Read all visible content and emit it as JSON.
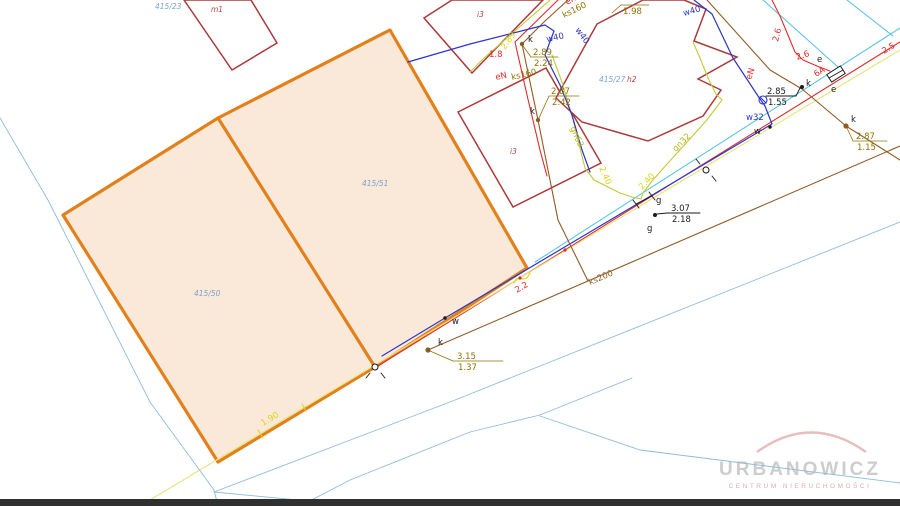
{
  "watermark": {
    "name": "URBANOWICZ",
    "subtitle": "CENTRUM NIERUCHOMOŚCI"
  },
  "map": {
    "parcel_highlight": {
      "points": "390,30 218,118 63,215 218,462 375,367 527,268"
    },
    "parcel_divider": {
      "points": "218,118 375,367"
    },
    "buildings": [
      {
        "name": "building-m1",
        "points": "184,0 232,70 277,43 251,0"
      },
      {
        "name": "building-i3-top",
        "points": "424,18 452,0 543,0 472,73"
      },
      {
        "name": "building-i3-mid",
        "points": "458,112 546,68 601,163 513,207"
      },
      {
        "name": "building-h2",
        "points": "643,0 597,24 556,98 582,122 648,141 703,116 721,90 698,79 737,57 694,41 706,9 684,0"
      }
    ],
    "ebox": {
      "points": "845.2,73.4 840.3,65.9 826.8,74.6 831.7,82.1",
      "inner": "843,70 829,78"
    },
    "lines": [
      {
        "name": "road-telecom-line",
        "cls": "ln-cyan",
        "points": "900,28 535,262"
      },
      {
        "name": "telecom-feeder-line",
        "cls": "ln-cyan",
        "points": "763,0 838,67"
      },
      {
        "name": "telecom-stub-line",
        "cls": "ln-cyan",
        "points": "847,0 893,36"
      },
      {
        "name": "power-road-line-eN",
        "cls": "ln-red",
        "points": "900,42 378,366"
      },
      {
        "name": "water-line-w40-w32",
        "cls": "ln-blue",
        "points": "694,0 712,14 733,58 758,96 765,106 772,124 445,318 382,356"
      },
      {
        "name": "gas-main-road-line",
        "cls": "ln-yellow",
        "points": "900,50 150,500"
      },
      {
        "name": "sewer-ks200-line",
        "cls": "ln-brown",
        "points": "900,146 588,281 428,350"
      },
      {
        "name": "sewer-ks160-line",
        "cls": "ln-brown",
        "points": "568,0 545,21 522,44 538,120 558,220 588,281"
      },
      {
        "name": "sewer-ne-service-line",
        "cls": "ln-brown",
        "points": "707,0 770,70 802,89 846,126 900,160"
      },
      {
        "name": "power-west-line-eN",
        "cls": "ln-red",
        "points": "558,0 515,42 527,95 540,150 547,176"
      },
      {
        "name": "power-ne-curve-eN",
        "cls": "ln-red",
        "points": "772,0 780,16 790,40 795,52 803,60 817,66 830,71"
      },
      {
        "name": "gas-west-service-line",
        "cls": "ln-gas",
        "points": "550,0 507,38 484,58 470,72"
      },
      {
        "name": "gas-gn63-line",
        "cls": "ln-gas",
        "points": "552,55 563,85 573,120 580,148 585,168 594,180 606,186 620,193 632,197 641,199"
      },
      {
        "name": "gas-gn32-line",
        "cls": "ln-gas",
        "points": "693,42 700,58 708,78 716,94 722,100 706,121 688,141 668,163 652,181 643,193 641,199"
      },
      {
        "name": "water-w40-west-line",
        "cls": "ln-blue",
        "points": "408,62 470,44 545,25 554,31 545,55 560,85 572,115 582,150 590,172"
      },
      {
        "name": "parcel-boundary-left",
        "cls": "ln-lblue",
        "points": "0,118 48,200 150,402 214,490 218,506"
      },
      {
        "name": "parcel-boundary-long",
        "cls": "ln-lblue",
        "points": "214,492 450,402 900,222"
      },
      {
        "name": "parcel-boundary-stub",
        "cls": "ln-lblue",
        "points": "214,492 360,506"
      },
      {
        "name": "parcel-boundary-se",
        "cls": "ln-lblue",
        "points": "540,416 640,450 900,483"
      },
      {
        "name": "parcel-boundary-curve",
        "cls": "ln-lblue",
        "points": "632,378 540,415 470,432 350,480 300,506"
      },
      {
        "name": "leader-k1",
        "cls": "ln-olive",
        "points": "523,46 531,57 558,57"
      },
      {
        "name": "leader-k2",
        "cls": "ln-olive",
        "points": "539,118 549,96 579,96"
      },
      {
        "name": "leader-k3",
        "cls": "ln-olive",
        "points": "430,351 453,361 503,361"
      },
      {
        "name": "leader-k4",
        "cls": "ln-olive",
        "points": "847,128 853,141 887,141"
      },
      {
        "name": "leader-k-black",
        "cls": "ln-blk",
        "points": "800,88 796,96 766,96"
      },
      {
        "name": "leader-g",
        "cls": "ln-blk",
        "points": "657,214 667,213 700,213"
      },
      {
        "name": "leader-198",
        "cls": "ln-olive",
        "points": "612,13 621,5 649,5"
      },
      {
        "name": "bench1-tick-a",
        "cls": "ln-blk",
        "points": "370,373 366,378"
      },
      {
        "name": "bench1-tick-b",
        "cls": "ln-blk",
        "points": "381,373 385,378"
      },
      {
        "name": "bench2-tick-a",
        "cls": "ln-blk",
        "points": "700,164 696,159"
      },
      {
        "name": "bench2-tick-b",
        "cls": "ln-blk",
        "points": "712,176 716,181"
      },
      {
        "name": "gas-valve-bracket-a",
        "cls": "ln-blk",
        "points": "633,200 639,208"
      },
      {
        "name": "gas-valve-bracket-b",
        "cls": "ln-blk",
        "points": "636,204 652,196"
      },
      {
        "name": "gas-valve-bracket-c",
        "cls": "ln-blk",
        "points": "649,192 655,200"
      },
      {
        "name": "water-valve-cross",
        "cls": "sym-blue ln",
        "points": "760,97 766,103"
      },
      {
        "name": "dist-tick-a",
        "cls": "ln-byellow",
        "points": "258,430 263,438"
      },
      {
        "name": "dist-tick-b",
        "cls": "ln-byellow",
        "points": "302,404 306,411"
      }
    ],
    "paths": [
      {
        "name": "gas-crossing-squiggle",
        "cls": "ln-byellow",
        "d": "M514,283 C518,272 524,286 530,273"
      },
      {
        "name": "watermark-arc",
        "cls": "",
        "d": "M757,452 Q811,413 866,452",
        "stroke": "#e7bdbd",
        "width": 2.5
      }
    ],
    "circles": [
      {
        "name": "water-valve-symbol",
        "cls": "sym-blue",
        "x": 763,
        "y": 100,
        "r": 4
      },
      {
        "name": "benchmark-point-1",
        "cls": "sym-stroke",
        "x": 375,
        "y": 367,
        "r": 3
      },
      {
        "name": "benchmark-point-2",
        "cls": "sym-stroke",
        "x": 706,
        "y": 170,
        "r": 3
      }
    ],
    "points": [
      {
        "name": "manhole-k1",
        "cls": "pt-brown",
        "x": 522,
        "y": 44,
        "r": 2.2
      },
      {
        "name": "manhole-k2",
        "cls": "pt-brown",
        "x": 538,
        "y": 120,
        "r": 2.2
      },
      {
        "name": "manhole-k3",
        "cls": "pt-brown",
        "x": 428,
        "y": 350,
        "r": 2.6
      },
      {
        "name": "manhole-k4",
        "cls": "pt-brown",
        "x": 846,
        "y": 126,
        "r": 2.6
      },
      {
        "name": "manhole-k-black",
        "cls": "pt-blk",
        "x": 802,
        "y": 87,
        "r": 2
      },
      {
        "name": "gas-point-g",
        "cls": "pt-blk",
        "x": 655,
        "y": 215,
        "r": 2
      },
      {
        "name": "water-point-1",
        "cls": "pt-blk",
        "x": 770,
        "y": 127,
        "r": 1.7
      },
      {
        "name": "water-point-2",
        "cls": "pt-blk",
        "x": 445,
        "y": 318,
        "r": 1.7
      },
      {
        "name": "cable-marker-1",
        "cls": "pt-red",
        "x": 565,
        "y": 250,
        "r": 1.6
      },
      {
        "name": "cable-marker-2",
        "cls": "pt-red",
        "x": 520,
        "y": 278,
        "r": 1.6
      }
    ],
    "labels": [
      {
        "name": "parcel-number-415-23",
        "text": "415/23",
        "x": 155,
        "y": 9,
        "rot": 0,
        "cls": "t-parcel"
      },
      {
        "name": "building-label-m1",
        "text": "m1",
        "x": 211,
        "y": 12,
        "rot": 0,
        "cls": "t-bldg"
      },
      {
        "name": "building-label-i3-top",
        "text": "i3",
        "x": 477,
        "y": 17,
        "rot": 0,
        "cls": "t-bldg"
      },
      {
        "name": "building-label-i3-mid",
        "text": "i3",
        "x": 510,
        "y": 154,
        "rot": 0,
        "cls": "t-bldg"
      },
      {
        "name": "building-label-h2",
        "text": "h2",
        "x": 627,
        "y": 82,
        "rot": 0,
        "cls": "t-bldg"
      },
      {
        "name": "parcel-number-415-27",
        "text": "415/27",
        "x": 599,
        "y": 82,
        "rot": 0,
        "cls": "t-parcel"
      },
      {
        "name": "parcel-number-415-51",
        "text": "415/51",
        "x": 362,
        "y": 186,
        "rot": 0,
        "cls": "t-parcel"
      },
      {
        "name": "parcel-number-415-50",
        "text": "415/50",
        "x": 194,
        "y": 296,
        "rot": 0,
        "cls": "t-parcel"
      },
      {
        "name": "power-label-eN-top",
        "text": "eN",
        "x": 567,
        "y": 5,
        "rot": -28,
        "cls": "t-red"
      },
      {
        "name": "sewer-label-ks160-top",
        "text": "ks160",
        "x": 564,
        "y": 18,
        "rot": -26,
        "cls": "t-olive"
      },
      {
        "name": "power-label-eN-mid",
        "text": "eN",
        "x": 496,
        "y": 80,
        "rot": -13,
        "cls": "t-red"
      },
      {
        "name": "sewer-label-ks160-mid",
        "text": "ks160",
        "x": 512,
        "y": 80,
        "rot": -13,
        "cls": "t-olive"
      },
      {
        "name": "dist-label-1-8",
        "text": "1.8",
        "x": 489,
        "y": 57,
        "rot": 0,
        "cls": "t-red"
      },
      {
        "name": "elev-k1-top",
        "text": "2.89",
        "x": 533,
        "y": 55,
        "rot": 0,
        "cls": "t-olive"
      },
      {
        "name": "elev-k1-bot",
        "text": "2.24",
        "x": 534,
        "y": 66,
        "rot": 0,
        "cls": "t-olive"
      },
      {
        "name": "point-label-k1",
        "text": "k",
        "x": 528,
        "y": 42,
        "rot": 0,
        "cls": "t-blk"
      },
      {
        "name": "point-label-k2",
        "text": "k",
        "x": 530,
        "y": 114,
        "rot": 0,
        "cls": "t-blk"
      },
      {
        "name": "elev-k2-top",
        "text": "2.87",
        "x": 551,
        "y": 94,
        "rot": 0,
        "cls": "t-olive"
      },
      {
        "name": "elev-k2-bot",
        "text": "2.42",
        "x": 552,
        "y": 105,
        "rot": 0,
        "cls": "t-olive"
      },
      {
        "name": "depth-label-289-gas",
        "text": "2.89",
        "x": 505,
        "y": 50,
        "rot": -55,
        "cls": "t-yellow"
      },
      {
        "name": "water-label-w40-a",
        "text": "w40",
        "x": 547,
        "y": 42,
        "rot": -12,
        "cls": "t-blue"
      },
      {
        "name": "water-label-w40-b",
        "text": "w40",
        "x": 575,
        "y": 30,
        "rot": 54,
        "cls": "t-blue"
      },
      {
        "name": "water-label-w40-c",
        "text": "w40",
        "x": 684,
        "y": 16,
        "rot": -16,
        "cls": "t-blue"
      },
      {
        "name": "elev-label-198",
        "text": "1.98",
        "x": 623,
        "y": 14,
        "rot": 0,
        "cls": "t-olive"
      },
      {
        "name": "gas-label-gn63",
        "text": "gn63",
        "x": 570,
        "y": 128,
        "rot": 66,
        "cls": "t-gas"
      },
      {
        "name": "depth-label-240-a",
        "text": "2.40",
        "x": 599,
        "y": 168,
        "rot": 66,
        "cls": "t-yellow"
      },
      {
        "name": "gas-label-gn32",
        "text": "gn32",
        "x": 676,
        "y": 152,
        "rot": -46,
        "cls": "t-gas"
      },
      {
        "name": "depth-label-240-b",
        "text": "2.40",
        "x": 642,
        "y": 190,
        "rot": -46,
        "cls": "t-yellow"
      },
      {
        "name": "sewer-label-ks200",
        "text": "ks200",
        "x": 590,
        "y": 285,
        "rot": -23,
        "cls": "t-brown"
      },
      {
        "name": "dist-label-2-2",
        "text": "2.2",
        "x": 517,
        "y": 293,
        "rot": -31,
        "cls": "t-red"
      },
      {
        "name": "dist-label-1-90",
        "text": "1.90",
        "x": 263,
        "y": 426,
        "rot": -31,
        "cls": "t-yellow"
      },
      {
        "name": "elev-k3-top",
        "text": "3.15",
        "x": 457,
        "y": 359,
        "rot": 0,
        "cls": "t-olive"
      },
      {
        "name": "elev-k3-bot",
        "text": "1.37",
        "x": 458,
        "y": 370,
        "rot": 0,
        "cls": "t-olive"
      },
      {
        "name": "point-label-k3",
        "text": "k",
        "x": 438,
        "y": 345,
        "rot": 0,
        "cls": "t-blk"
      },
      {
        "name": "point-label-w2",
        "text": "w",
        "x": 452,
        "y": 324,
        "rot": 0,
        "cls": "t-blk"
      },
      {
        "name": "elev-g-top",
        "text": "3.07",
        "x": 671,
        "y": 211,
        "rot": 0,
        "cls": "t-blk"
      },
      {
        "name": "elev-g-bot",
        "text": "2.18",
        "x": 672,
        "y": 222,
        "rot": 0,
        "cls": "t-blk"
      },
      {
        "name": "point-label-g-dot",
        "text": "g",
        "x": 647,
        "y": 231,
        "rot": 0,
        "cls": "t-blk"
      },
      {
        "name": "point-label-g-valve",
        "text": "g",
        "x": 656,
        "y": 203,
        "rot": 0,
        "cls": "t-blk"
      },
      {
        "name": "elev-k4-top",
        "text": "2.87",
        "x": 856,
        "y": 139,
        "rot": 0,
        "cls": "t-olive"
      },
      {
        "name": "elev-k4-bot",
        "text": "1.15",
        "x": 857,
        "y": 150,
        "rot": 0,
        "cls": "t-olive"
      },
      {
        "name": "point-label-k4",
        "text": "k",
        "x": 851,
        "y": 122,
        "rot": 0,
        "cls": "t-blk"
      },
      {
        "name": "elev-kblack-top",
        "text": "2.85",
        "x": 767,
        "y": 94,
        "rot": 0,
        "cls": "t-blk"
      },
      {
        "name": "elev-kblack-bot",
        "text": "1.55",
        "x": 768,
        "y": 105,
        "rot": 0,
        "cls": "t-blk"
      },
      {
        "name": "point-label-k-black",
        "text": "k",
        "x": 806,
        "y": 86,
        "rot": 0,
        "cls": "t-blk"
      },
      {
        "name": "point-label-w1",
        "text": "w",
        "x": 754,
        "y": 134,
        "rot": 0,
        "cls": "t-blk"
      },
      {
        "name": "water-label-w32",
        "text": "w32",
        "x": 746,
        "y": 120,
        "rot": 0,
        "cls": "t-blue"
      },
      {
        "name": "point-label-e1",
        "text": "e",
        "x": 817,
        "y": 62,
        "rot": 0,
        "cls": "t-blk"
      },
      {
        "name": "point-label-e2",
        "text": "e",
        "x": 831,
        "y": 92,
        "rot": 0,
        "cls": "t-blk"
      },
      {
        "name": "power-label-eN-ne",
        "text": "eN",
        "x": 751,
        "y": 80,
        "rot": -72,
        "cls": "t-red"
      },
      {
        "name": "dist-label-2-6-a",
        "text": "2.6",
        "x": 778,
        "y": 42,
        "rot": -76,
        "cls": "t-red"
      },
      {
        "name": "dist-label-2-6-b",
        "text": "2.6",
        "x": 797,
        "y": 60,
        "rot": -18,
        "cls": "t-red"
      },
      {
        "name": "cable-label-6A",
        "text": "6A",
        "x": 816,
        "y": 77,
        "rot": -31,
        "cls": "t-red"
      },
      {
        "name": "dist-label-2-5",
        "text": "2.5",
        "x": 884,
        "y": 54,
        "rot": -31,
        "cls": "t-red"
      }
    ]
  }
}
